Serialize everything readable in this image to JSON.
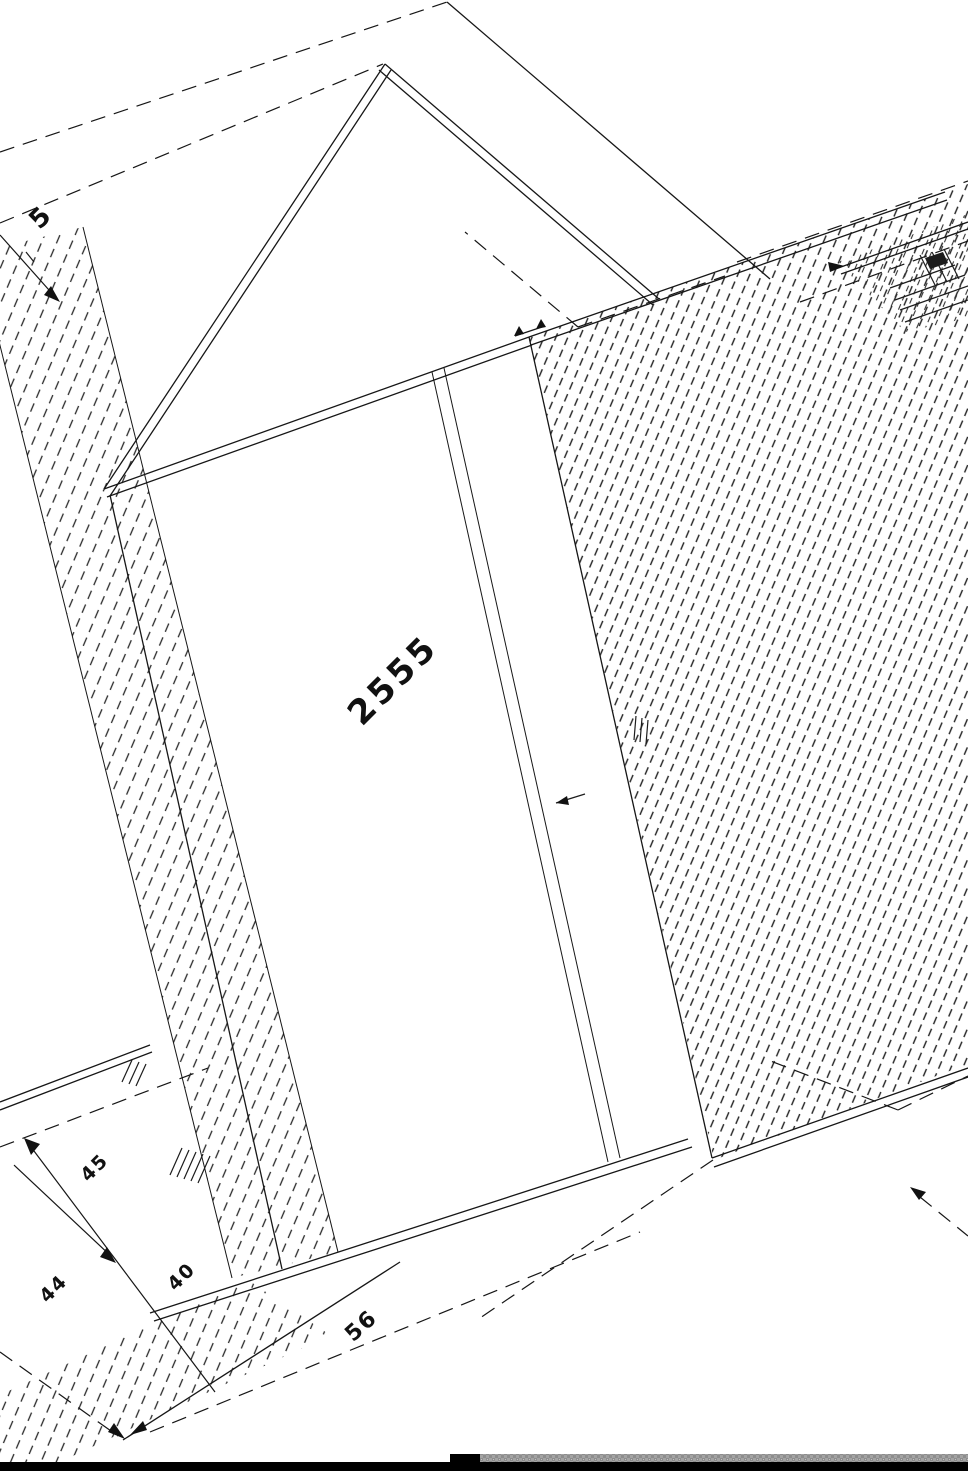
{
  "document": {
    "kind": "rotated CAD technical drawing of cabinet / wardrobe panels",
    "background_color": "#ffffff",
    "line_color": "#161616"
  },
  "labels": {
    "dim_main": "2555",
    "dim_top_left": "5",
    "dim_left_upper": "45",
    "dim_left_lower": "44",
    "dim_left_mid": "40",
    "dim_bottom": "56"
  },
  "footer": {
    "black_bar_color": "#000000",
    "gray_strip_color": "#a3a3a3"
  }
}
